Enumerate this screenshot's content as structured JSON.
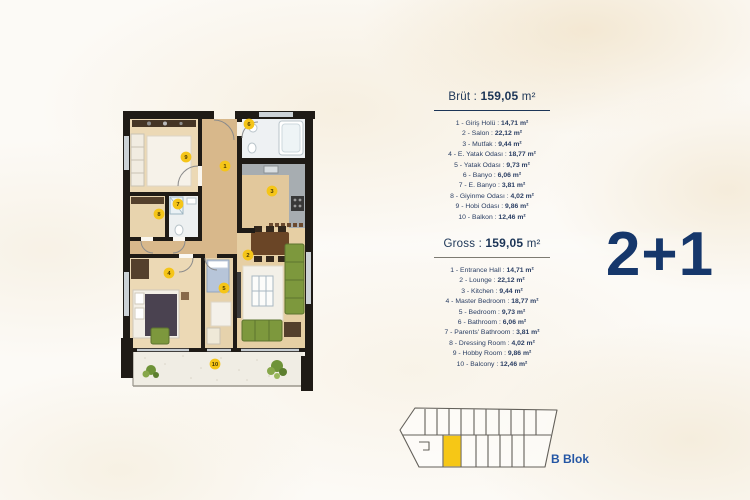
{
  "unit_type": "2+1",
  "block": {
    "label": "B Blok",
    "highlight_color": "#f6c716"
  },
  "plan_markers": [
    "1",
    "2",
    "3",
    "4",
    "5",
    "6",
    "7",
    "8",
    "9",
    "10"
  ],
  "colors": {
    "accent_navy": "#1c3557",
    "marker_yellow": "#f5c518",
    "wall_black": "#1f1b16",
    "sofa_green": "#7d983d",
    "wood_light": "#ecd9b5",
    "wood_hall": "#d8b88b"
  },
  "brut": {
    "label": "Brüt :",
    "value": "159,05",
    "unit": "m²",
    "items": [
      {
        "prefix": "1 - Giriş Holü :",
        "value": "14,71 m²"
      },
      {
        "prefix": "2 - Salon :",
        "value": "22,12 m²"
      },
      {
        "prefix": "3 - Mutfak :",
        "value": "9,44 m²"
      },
      {
        "prefix": "4 - E. Yatak Odası :",
        "value": "18,77 m²"
      },
      {
        "prefix": "5 - Yatak Odası :",
        "value": "9,73 m²"
      },
      {
        "prefix": "6 - Banyo :",
        "value": "6,06 m²"
      },
      {
        "prefix": "7 - E. Banyo :",
        "value": "3,81 m²"
      },
      {
        "prefix": "8 - Giyinme Odası :",
        "value": "4,02 m²"
      },
      {
        "prefix": "9 - Hobi Odası :",
        "value": "9,86 m²"
      },
      {
        "prefix": "10 - Balkon :",
        "value": "12,46 m²"
      }
    ]
  },
  "gross": {
    "label": "Gross :",
    "value": "159,05",
    "unit": "m²",
    "items": [
      {
        "prefix": "1 - Entrance Hall :",
        "value": "14,71 m²"
      },
      {
        "prefix": "2 - Lounge :",
        "value": "22,12 m²"
      },
      {
        "prefix": "3 - Kitchen :",
        "value": "9,44 m²"
      },
      {
        "prefix": "4 - Master Bedroom :",
        "value": "18,77 m²"
      },
      {
        "prefix": "5 - Bedroom :",
        "value": "9,73 m²"
      },
      {
        "prefix": "6 - Bathroom :",
        "value": "6,06 m²"
      },
      {
        "prefix": "7 - Parents' Bathroom :",
        "value": "3,81 m²"
      },
      {
        "prefix": "8 - Dressing Room :",
        "value": "4,02 m²"
      },
      {
        "prefix": "9 - Hobby Room :",
        "value": "9,86 m²"
      },
      {
        "prefix": "10 - Balcony :",
        "value": "12,46 m²"
      }
    ]
  }
}
